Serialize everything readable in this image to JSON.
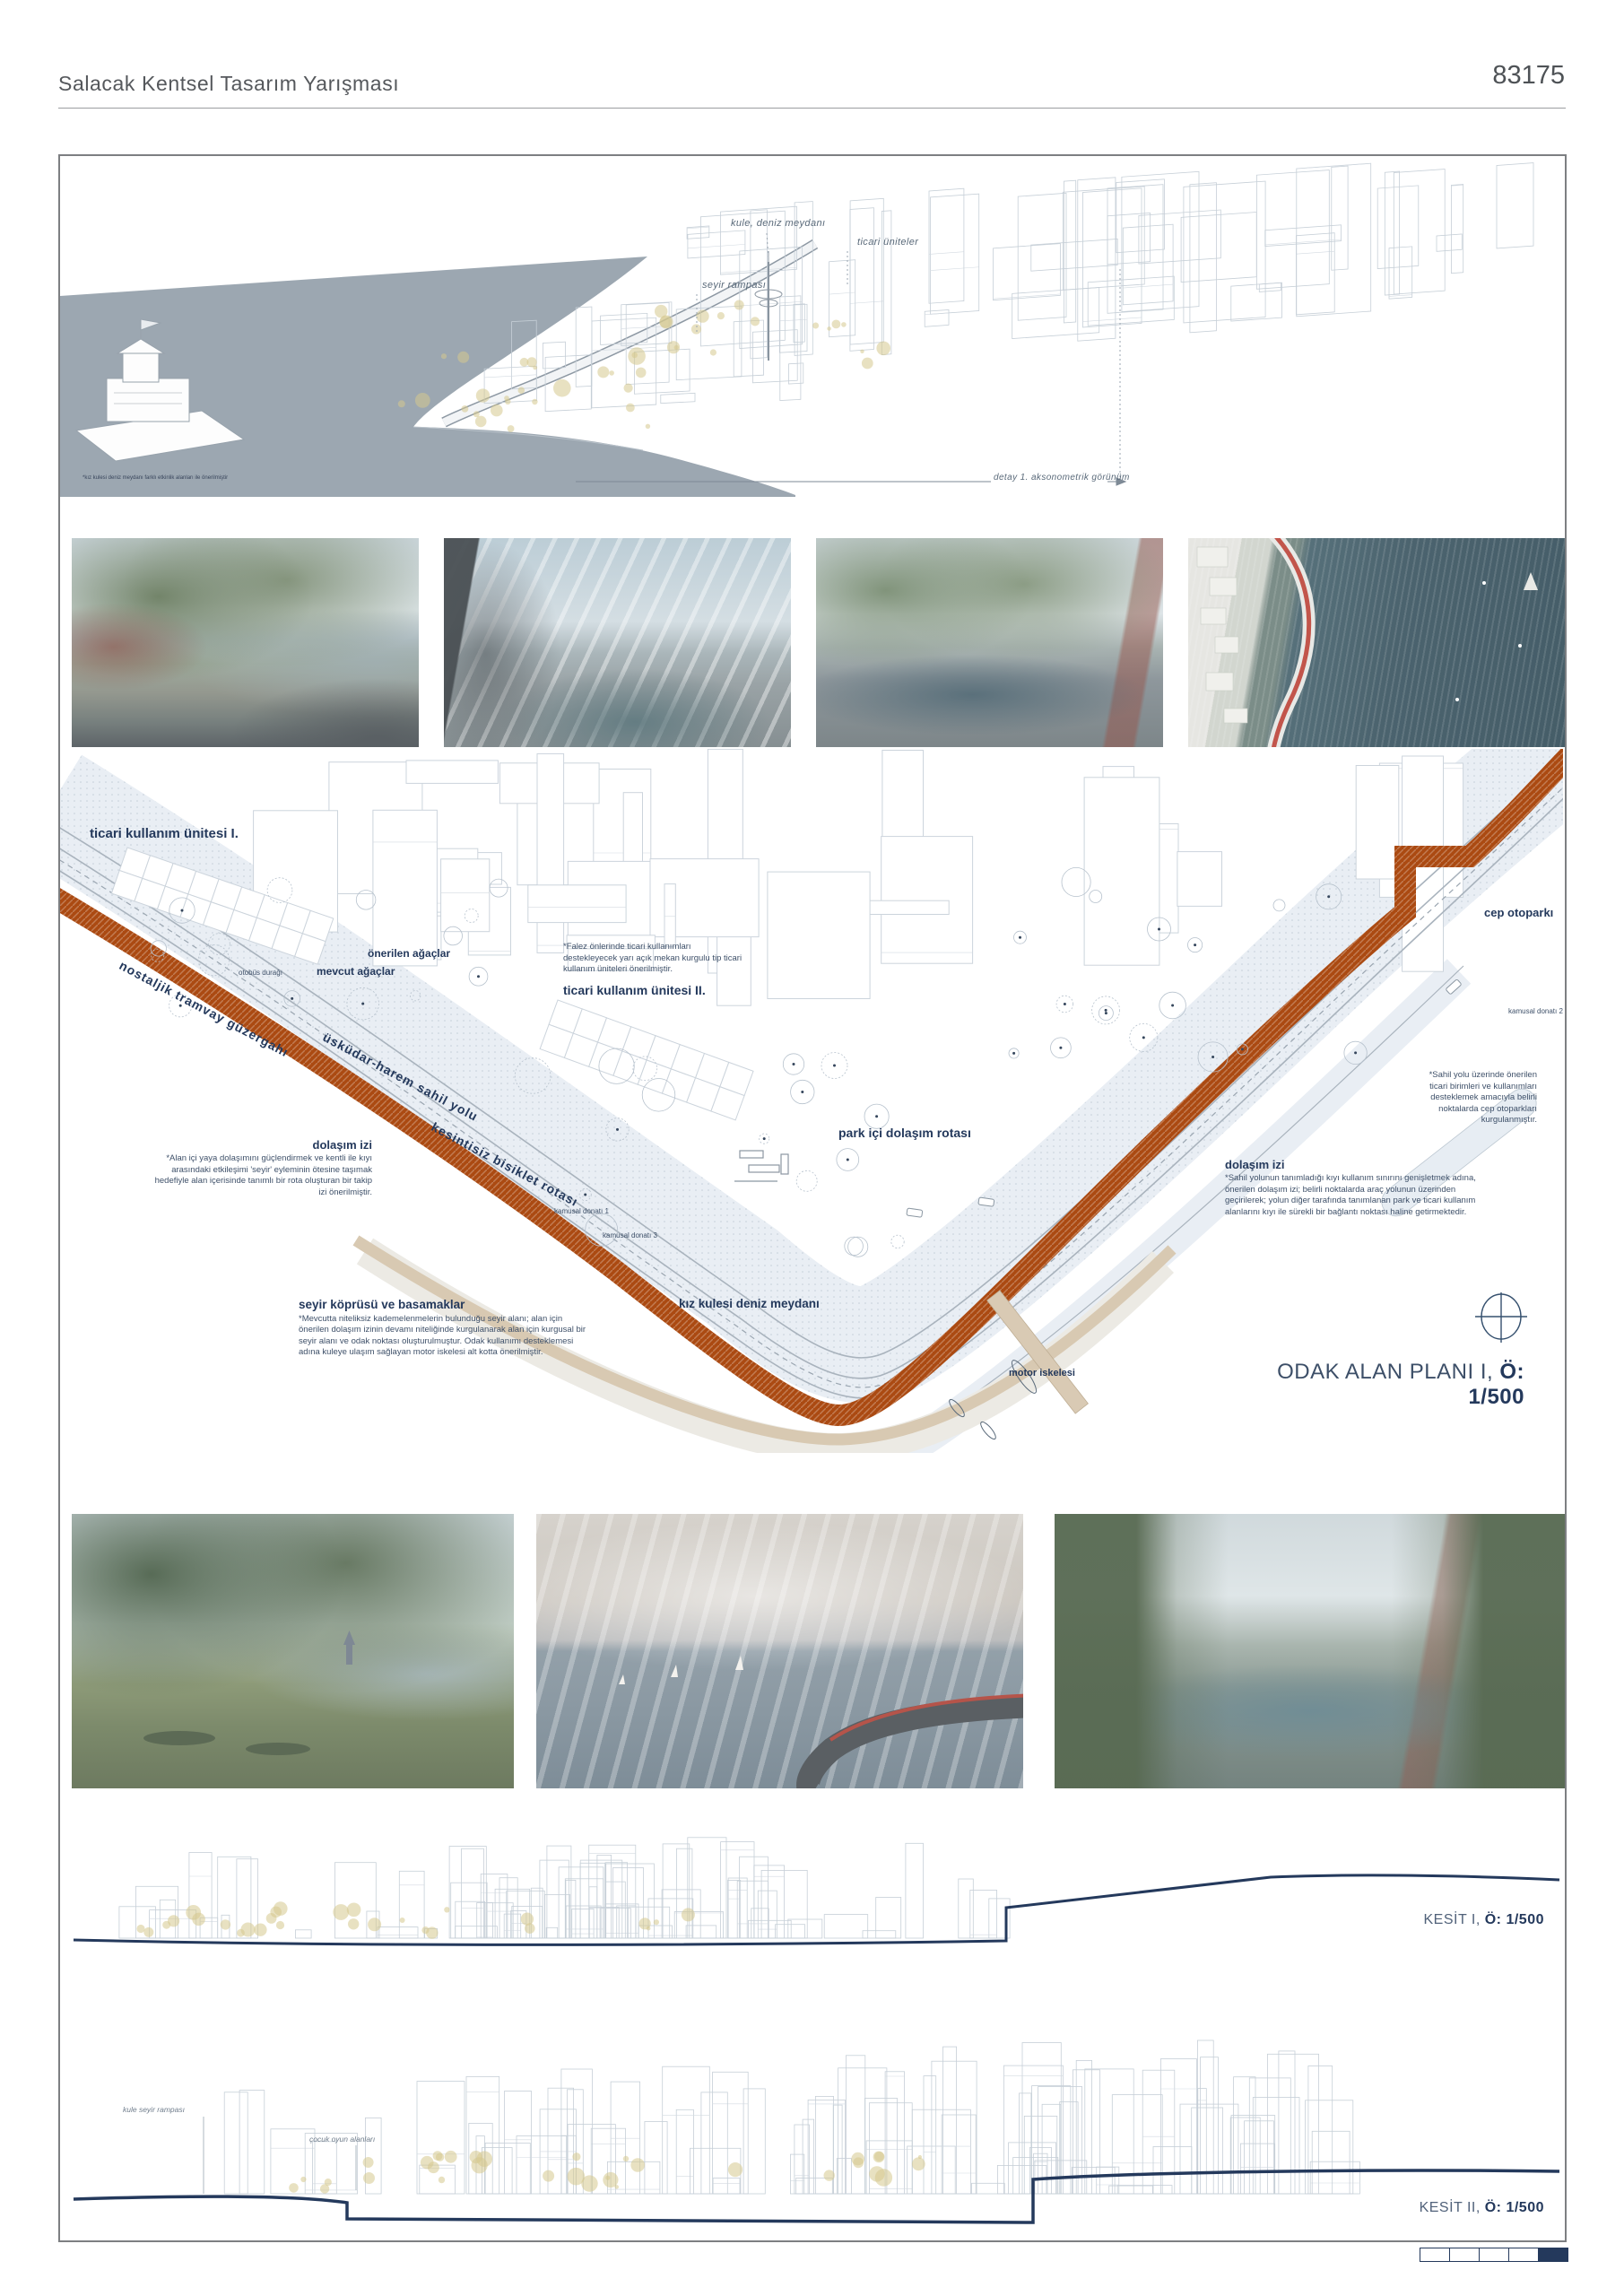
{
  "header": {
    "title": "Salacak Kentsel Tasarım Yarışması",
    "code": "83175"
  },
  "colors": {
    "accent_orange": "#AB4A12",
    "navy": "#24395C",
    "tan": "#D9CAB4",
    "water_gray": "#9CA7B1",
    "park_fill": "#E9EEF4"
  },
  "axon": {
    "label_kule": "kule, deniz meydanı",
    "label_ticari": "ticari üniteler",
    "label_seyir": "seyir rampası",
    "caption": "detay 1. aksonometrik görünüm",
    "tower_note": "*kız kulesi deniz meydanı farklı etkinlik alanları ile önerilmiştir"
  },
  "plan": {
    "unit1": "ticari kullanım ünitesi I.",
    "unit2": "ticari kullanım ünitesi II.",
    "tram": "nostaljik tramvay güzergahı",
    "sahil": "üsküdar-harem sahil yolu",
    "bisiklet": "kesintisiz bisiklet rotası",
    "mevcut": "mevcut ağaçlar",
    "onerilen": "önerilen ağaçlar",
    "otobus": "otobüs durağı",
    "falez_note": "*Falez önlerinde ticari kullanımları destekleyecek yarı açık mekan kurgulu tip ticari kullanım üniteleri önerilmiştir.",
    "park_rota": "park içi dolaşım rotası",
    "dolasim1_title": "dolaşım izi",
    "dolasim1_body": "*Alan içi yaya dolaşımını güçlendirmek ve kentli ile kıyı arasındaki etkileşimi 'seyir' eyleminin ötesine taşımak hedefiyle alan içerisinde tanımlı bir rota oluşturan bir takip izi önerilmiştir.",
    "seyir_title": "seyir köprüsü ve basamaklar",
    "seyir_body": "*Mevcutta niteliksiz kademelenmelerin bulunduğu seyir alanı; alan için önerilen dolaşım izinin devamı niteliğinde kurgulanarak alan için kurgusal bir seyir alanı ve odak noktası oluşturulmuştur. Odak kullanımı desteklemesi adına kuleye ulaşım sağlayan motor iskelesi alt kotta önerilmiştir.",
    "kizkulesi": "kız kulesi deniz meydanı",
    "motor": "motor iskelesi",
    "cep": "cep otoparkı",
    "cep_note": "*Sahil yolu üzerinde önerilen ticari birimleri ve kullanımları desteklemek amacıyla belirli noktalarda cep otoparkları kurgulanmıştır.",
    "dolasim2_title": "dolaşım izi",
    "dolasim2_body": "*Sahil yolunun tanımladığı kıyı kullanım sınırını genişletmek adına, önerilen dolaşım izi; belirli noktalarda araç yolunun üzerinden geçirilerek; yolun diğer tarafında tanımlanan park ve ticari kullanım alanlarını kıyı ile sürekli bir bağlantı noktası haline getirmektedir.",
    "kamusal1": "kamusal donatı 1",
    "kamusal2": "kamusal donatı 2",
    "kamusal3": "kamusal donatı 3",
    "title": "ODAK ALAN PLANI I, ",
    "scale": "Ö: 1/500"
  },
  "sections": {
    "k1": "KESİT I, ",
    "k1_scale": "Ö: 1/500",
    "k2": "KESİT II, ",
    "k2_scale": "Ö: 1/500",
    "kule_rampa": "kule seyir rampası",
    "cocuk": "çocuk oyun alanları"
  }
}
